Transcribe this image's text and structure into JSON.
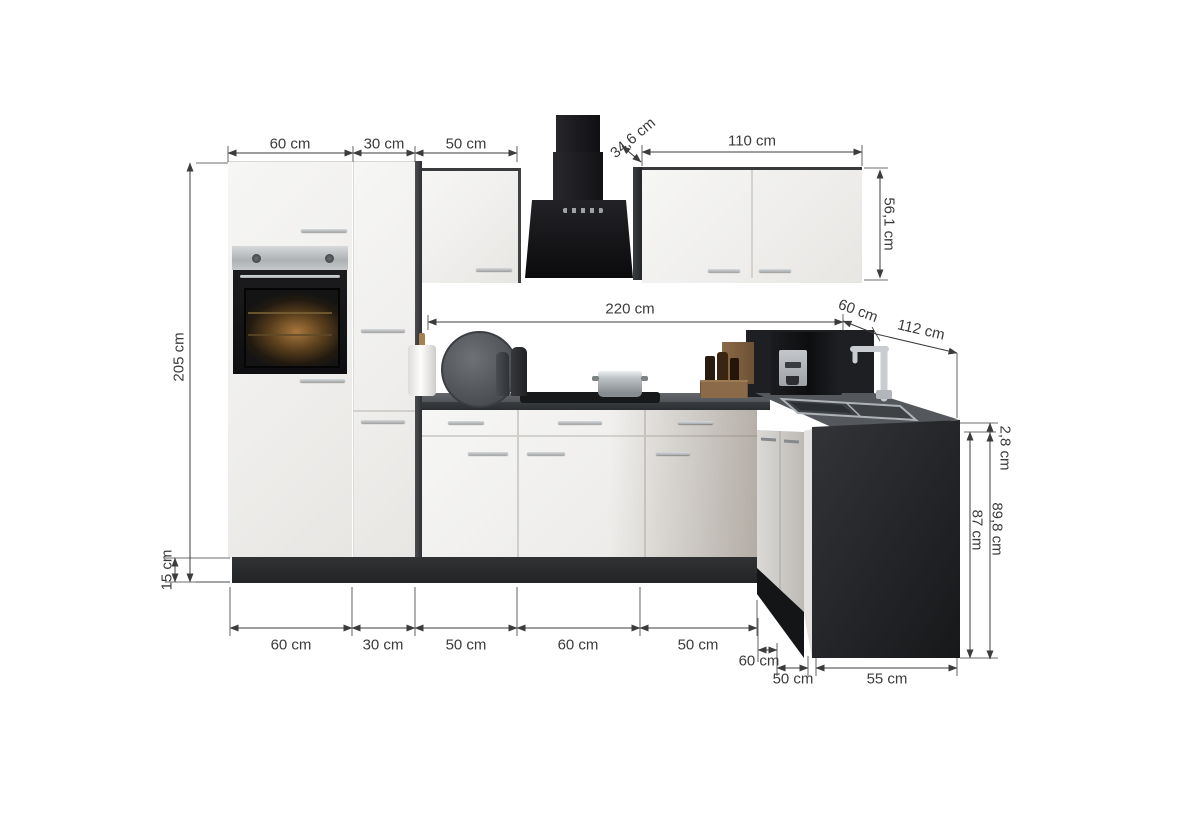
{
  "diagram": {
    "type": "kitchen-corner-unit dimension drawing",
    "unit": "cm",
    "dims": {
      "top": {
        "oven_housing_width": "60 cm",
        "tall_cabinet_width": "30 cm",
        "wall_cabinet_width": "50 cm",
        "wall_cabinet_depth": "34,6 cm",
        "double_wall_cabinet_width": "110 cm",
        "wall_cabinet_height": "56,1 cm"
      },
      "middle": {
        "worktop_run": "220 cm",
        "corner_unit": "60 cm",
        "right_run": "112 cm"
      },
      "left": {
        "tall_unit_height": "205 cm",
        "plinth_height": "15 cm"
      },
      "right": {
        "worktop_thickness": "2,8 cm",
        "base_unit_height": "87 cm",
        "worktop_height_total": "89,8 cm"
      },
      "bottom": {
        "segments": [
          "60 cm",
          "30 cm",
          "50 cm",
          "60 cm",
          "50 cm"
        ],
        "corner_depth": "60 cm",
        "right_segment_1": "50 cm",
        "right_segment_2": "55 cm"
      }
    },
    "colors": {
      "cabinet_front": "#f3f2f0",
      "carcase_anthracite": "#2a2c2e",
      "worktop": "#56595d",
      "appliance_black": "#141416",
      "dimension_line": "#3c3c3c"
    }
  }
}
